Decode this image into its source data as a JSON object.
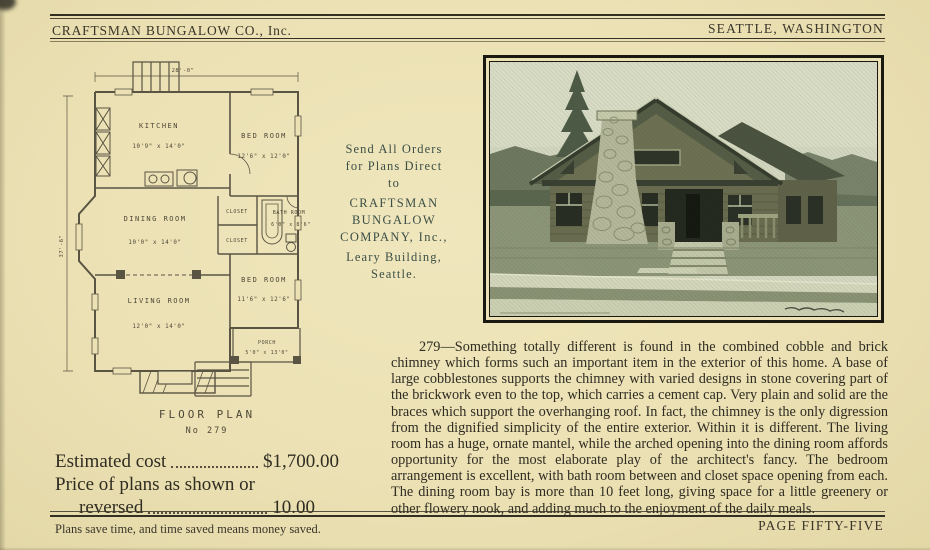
{
  "header": {
    "company": "CRAFTSMAN BUNGALOW CO., Inc.",
    "location": "SEATTLE, WASHINGTON"
  },
  "floor_plan": {
    "title": "FLOOR PLAN",
    "number": "No 279",
    "width_dim": "28'-0\"",
    "depth_dim": "37'-6\"",
    "kitchen": {
      "label": "KITCHEN",
      "dims": "10'9\" x 14'0\""
    },
    "bedroom1": {
      "label": "BED ROOM",
      "dims": "12'6\" x 12'0\""
    },
    "dining_room": {
      "label": "DINING ROOM",
      "dims": "10'0\" x 14'0\""
    },
    "closet_upper": {
      "label": "CLOSET"
    },
    "closet_lower": {
      "label": "CLOSET"
    },
    "bathroom": {
      "label": "BATH ROOM",
      "dims": "6'0\" x 8'6\""
    },
    "living_room": {
      "label": "LIVING ROOM",
      "dims": "12'0\" x 14'0\""
    },
    "bedroom2": {
      "label": "BED ROOM",
      "dims": "11'6\" x 12'6\""
    },
    "porch": {
      "label": "PORCH",
      "dims": "5'0\" x 13'0\""
    }
  },
  "order_info": {
    "lines": [
      "Send All Orders",
      "for Plans Direct",
      "to",
      "CRAFTSMAN BUNGALOW",
      "COMPANY, Inc.,",
      "Leary Building,",
      "Seattle."
    ]
  },
  "description": {
    "text": "279—Something totally different is found in the combined cobble and brick chimney which forms such an important item in the exterior of this home.  A base of large cobblestones supports the chimney with varied designs in stone covering part of the brickwork even to the top, which carries a cement cap.  Very plain and solid are the braces which support the overhanging roof.  In fact, the chimney is the only digression from the dignified simplicity of the entire exterior.  Within it is different.  The living room has a huge, ornate mantel, while the arched opening into the dining room affords opportunity for the most elaborate play of the architect's fancy.  The bedroom arrangement is excellent, with bath room between and closet space opening from each.  The dining room bay is more than 10 feet long, giving space for a little greenery or other flowery nook, and adding much to the enjoyment of the daily meals."
  },
  "pricing": {
    "cost_label": "Estimated cost",
    "cost_value": "$1,700.00",
    "plans_label_line1": "Price of plans as shown or",
    "plans_label_line2": "reversed",
    "plans_value": "10.00"
  },
  "footer": {
    "slogan": "Plans save time, and time saved means money saved.",
    "page_label": "PAGE FIFTY-FIVE"
  },
  "colors": {
    "paper": "#ebe1b4",
    "ink": "#332f22",
    "photo_tone": "#6b745a"
  }
}
